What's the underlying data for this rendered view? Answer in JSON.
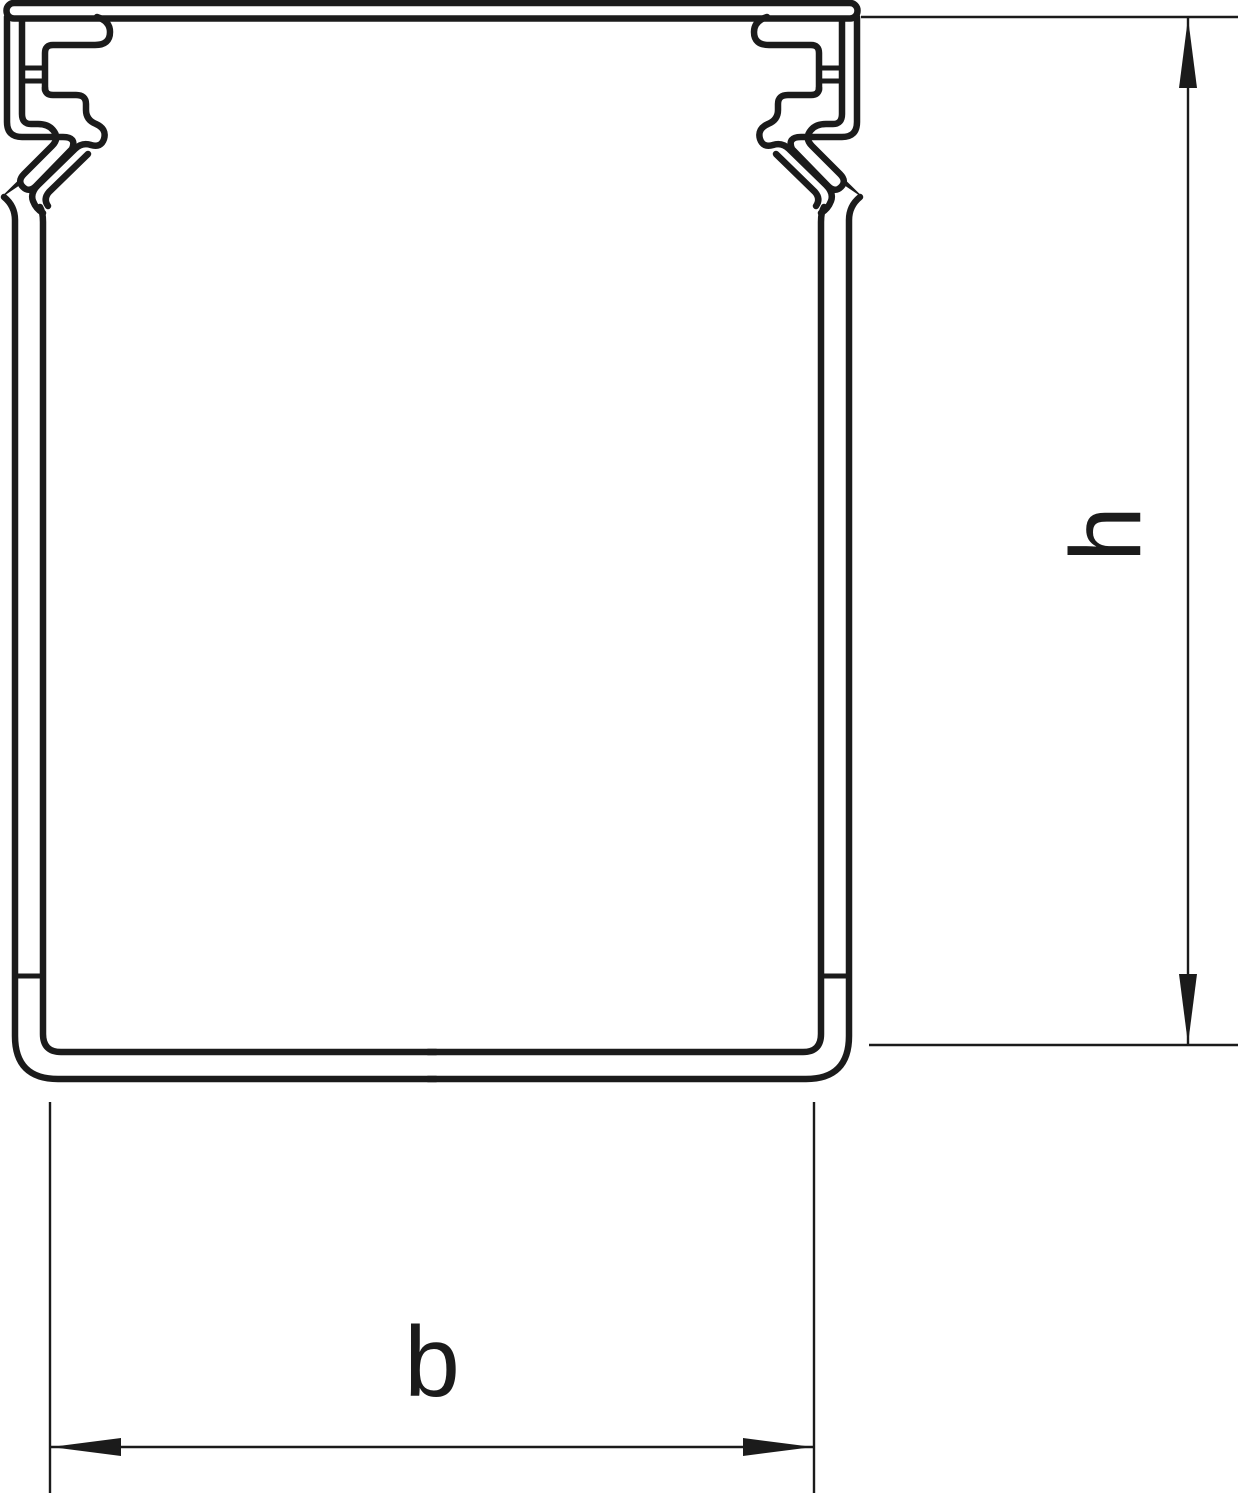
{
  "drawing": {
    "labels": {
      "height_dimension": "h",
      "width_dimension": "b"
    },
    "colors": {
      "line": "#1b1b1b",
      "background": "#ffffff"
    }
  }
}
